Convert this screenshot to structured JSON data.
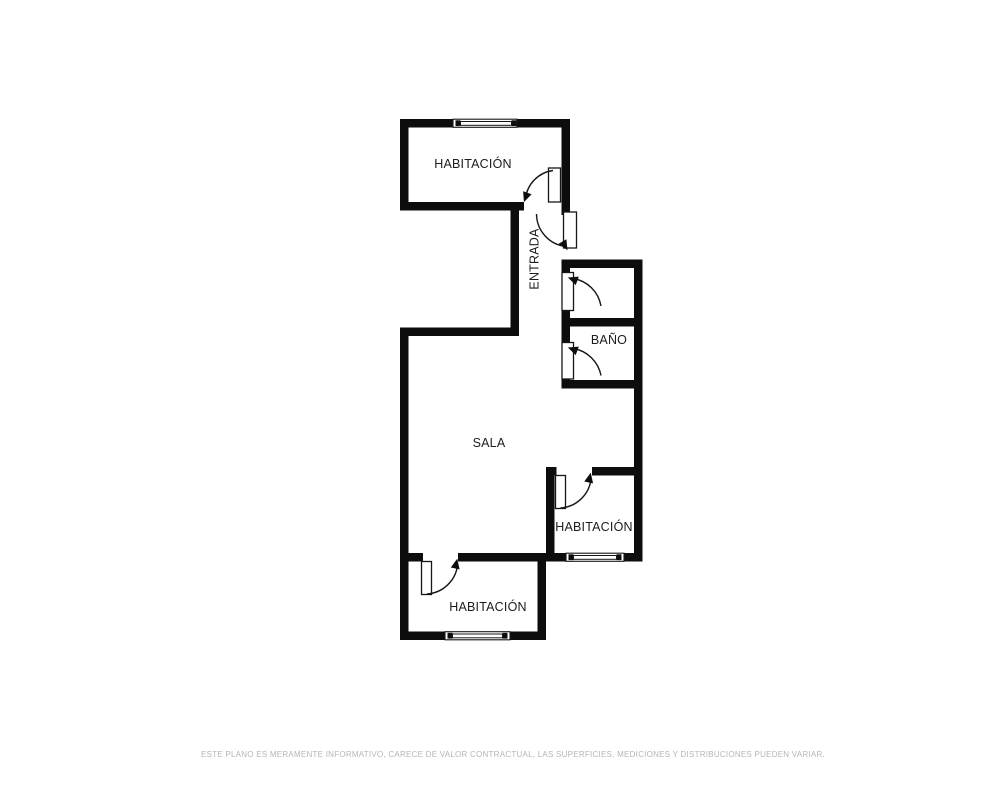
{
  "plan": {
    "title": "floor-plan",
    "rooms": [
      {
        "id": "habitacion-top",
        "label": "HABITACIÓN"
      },
      {
        "id": "entrada",
        "label": "ENTRADA"
      },
      {
        "id": "bano",
        "label": "BAÑO"
      },
      {
        "id": "sala",
        "label": "SALA"
      },
      {
        "id": "habitacion-middle",
        "label": "HABITACIÓN"
      },
      {
        "id": "habitacion-bottom",
        "label": "HABITACIÓN"
      }
    ],
    "door_count": 6,
    "window_count": 3,
    "colors": {
      "wall": "#0d0d0d",
      "line": "#161616",
      "label": "#1c1c1c",
      "disclaimer_text": "#b5b5b5",
      "background": "#ffffff"
    }
  },
  "footer": {
    "disclaimer": "ESTE PLANO ES MERAMENTE INFORMATIVO, CARECE DE VALOR CONTRACTUAL, LAS SUPERFICIES, MEDICIONES Y DISTRIBUCIONES PUEDEN VARIAR."
  }
}
